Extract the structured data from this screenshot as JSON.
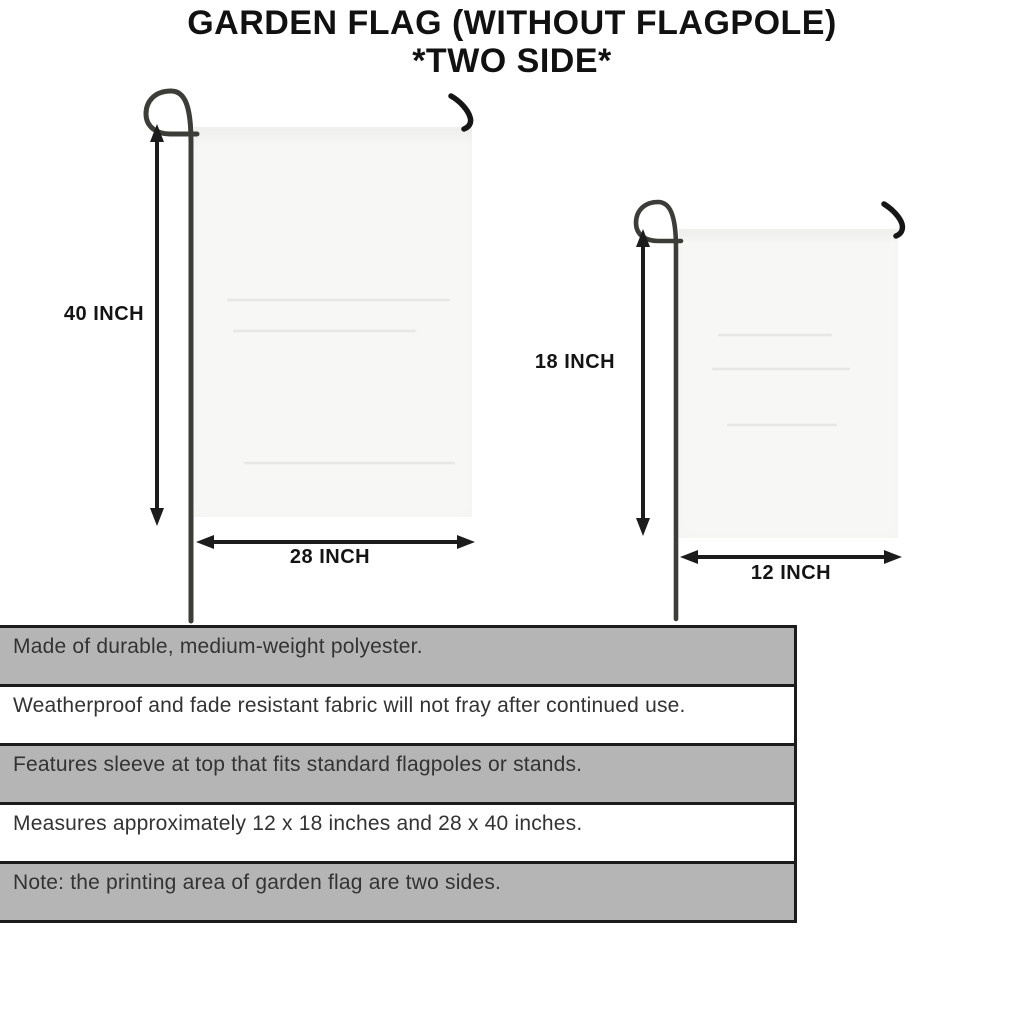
{
  "title": {
    "line1": "GARDEN FLAG (WITHOUT FLAGPOLE)",
    "line2": "*TWO SIDE*"
  },
  "diagrams": {
    "large_flag": {
      "name": "28 x 40 inch garden flag",
      "height_label": "40 INCH",
      "width_label": "28 INCH"
    },
    "small_flag": {
      "name": "12 x 18 inch garden flag",
      "height_label": "18 INCH",
      "width_label": "12 INCH"
    }
  },
  "features": {
    "rows": [
      {
        "text": "Made of durable, medium-weight polyester.",
        "shaded": true
      },
      {
        "text": "Weatherproof and fade resistant fabric will not fray after continued use.",
        "shaded": false
      },
      {
        "text": "Features sleeve at top that fits standard flagpoles or stands.",
        "shaded": true
      },
      {
        "text": "Measures approximately 12 x 18 inches and 28 x 40 inches.",
        "shaded": false
      },
      {
        "text": "Note: the printing area of garden flag are two sides.",
        "shaded": true
      }
    ]
  },
  "icons": {
    "pole": "shepherd-hook-flagpole",
    "clip": "flag-corner-hook"
  },
  "colors": {
    "row_shaded": "#b5b5b5",
    "row_plain": "#ffffff",
    "table_border": "#1c1c1c",
    "flag_fabric": "#f7f7f6",
    "pole": "#3c3c38",
    "arrow": "#1c1c1c",
    "title_text": "#111111",
    "feature_text": "#333333"
  }
}
